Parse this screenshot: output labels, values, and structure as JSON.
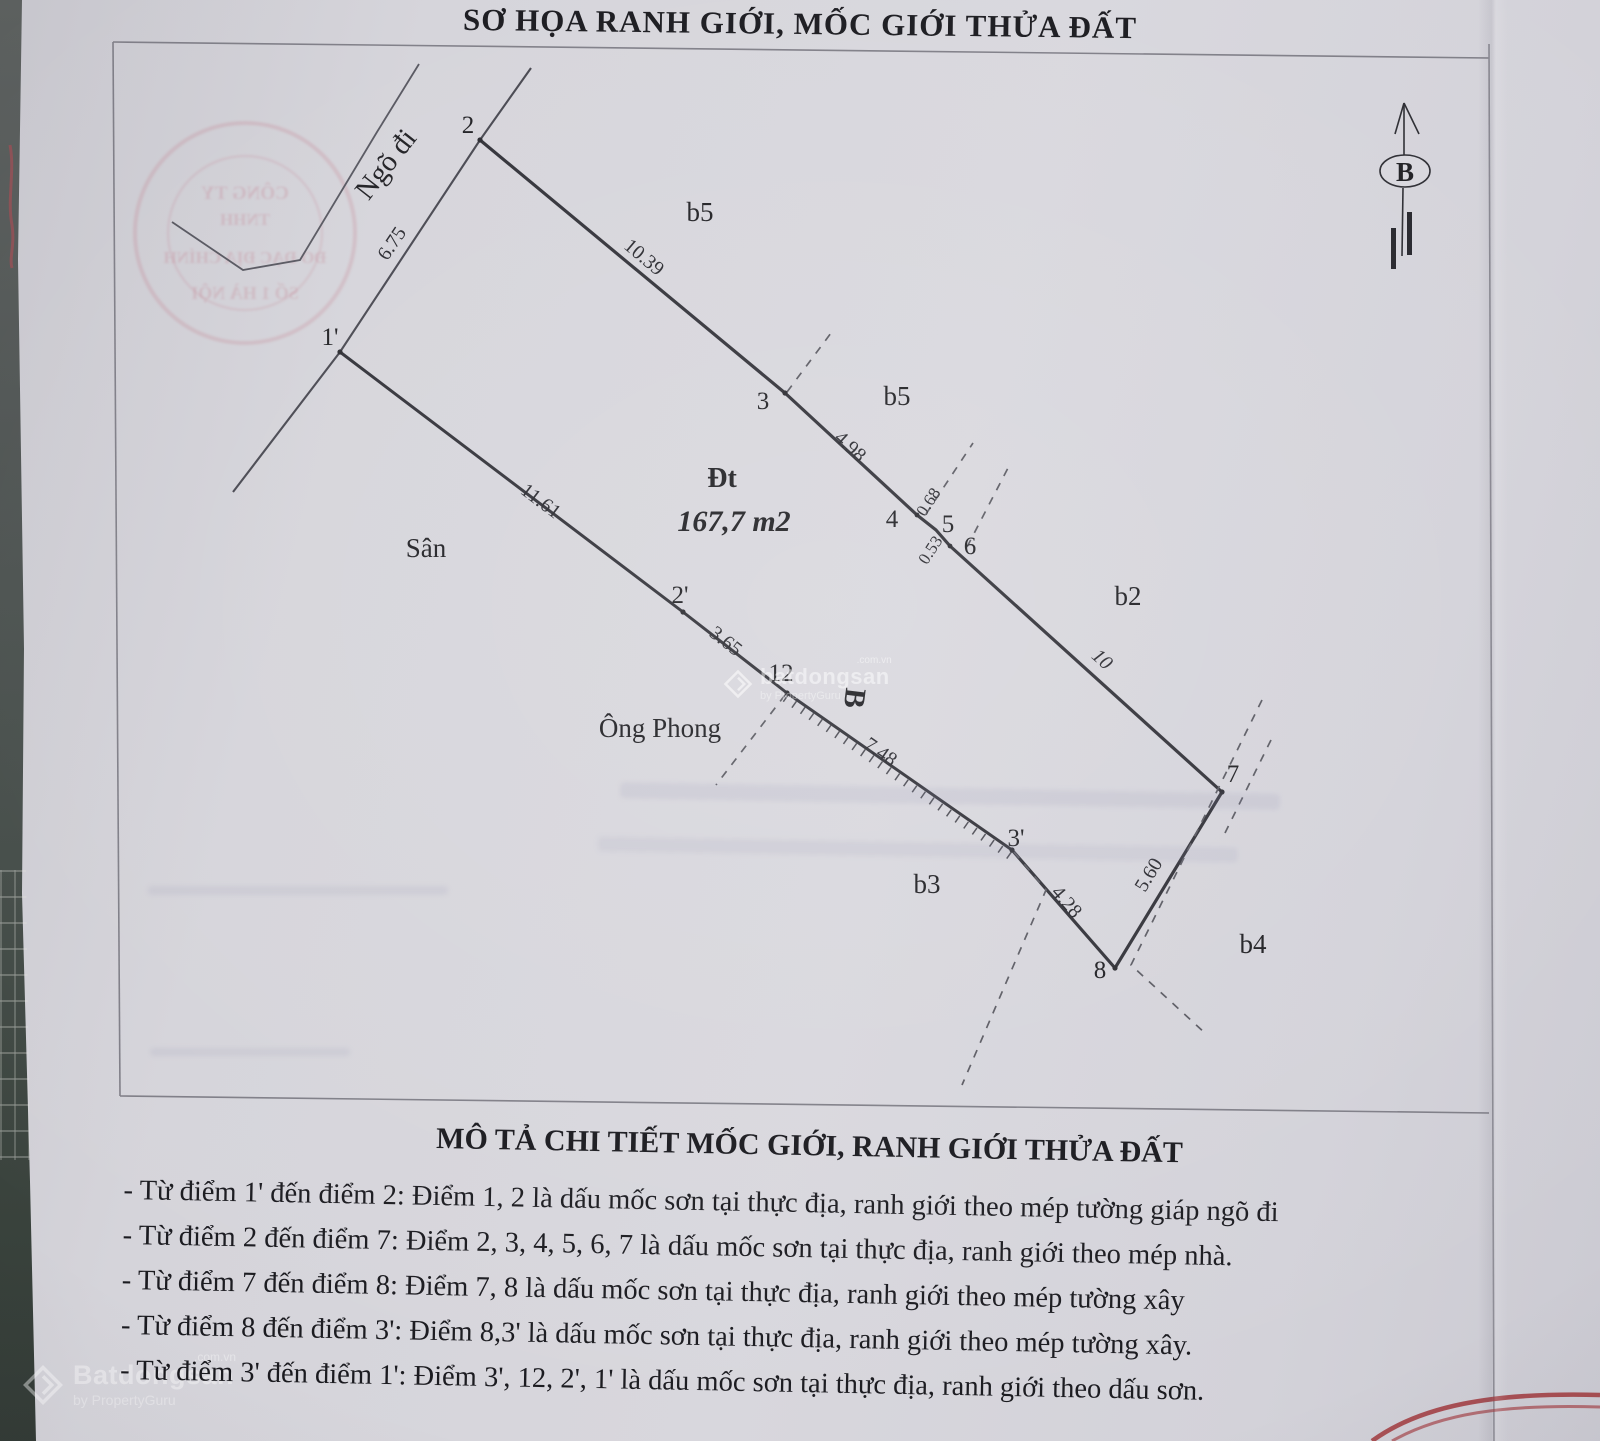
{
  "title": "SƠ HỌA RANH GIỚI, MỐC GIỚI THỬA ĐẤT",
  "north": {
    "label": "B"
  },
  "diagram": {
    "road_label": "Ngõ đi",
    "yard_label": "Sân",
    "neighbor_label": "Ông Phong",
    "plot_code": "Đt",
    "plot_area": "167,7 m2",
    "rotated_b": "B",
    "zones": {
      "b5_top": "b5",
      "b5_mid": "b5",
      "b2": "b2",
      "b3": "b3",
      "b4": "b4"
    },
    "points": {
      "p1p": "1'",
      "p2": "2",
      "p2p": "2'",
      "p3": "3",
      "p3p": "3'",
      "p4": "4",
      "p5": "5",
      "p6": "6",
      "p7": "7",
      "p8": "8",
      "p12": "12"
    },
    "lengths": {
      "l1p_2": "6.75",
      "l2_3": "10.39",
      "l3_4": "4.98",
      "l4_5": "0.68",
      "l5_6": "0.53",
      "l6_7": "10",
      "l7_8": "5.60",
      "l3p_8": "4.28",
      "l12_3p": "7.48",
      "l2p_12": "3.65",
      "l1p_2p": "11.61"
    }
  },
  "description": {
    "heading": "MÔ TẢ CHI TIẾT MỐC GIỚI, RANH GIỚI THỬA ĐẤT",
    "items": [
      "- Từ điểm 1' đến điểm 2:  Điểm 1, 2 là dấu mốc sơn tại thực địa, ranh giới theo mép tường giáp ngõ đi",
      "- Từ điểm 2 đến điểm 7:  Điểm 2, 3, 4, 5, 6, 7 là dấu mốc sơn tại thực địa, ranh giới theo mép nhà.",
      "- Từ điểm 7 đến điểm 8:  Điểm 7, 8 là dấu mốc sơn tại thực địa, ranh giới theo mép tường xây",
      "- Từ điểm 8 đến điểm 3':  Điểm 8,3' là dấu mốc sơn tại thực địa, ranh giới theo mép tường xây.",
      "- Từ điểm 3' đến điểm 1':  Điểm 3', 12, 2', 1' là dấu mốc sơn tại thực địa, ranh giới theo dấu sơn."
    ]
  },
  "stamp": {
    "lines": [
      "CÔNG TY",
      "TNHH",
      "ĐO ĐẠC ĐỊA CHÍNH",
      "SỐ 1 HÀ NỘI"
    ]
  },
  "watermark": {
    "brand": "Batdongsan",
    "brand_lower": "batdongsan",
    "domain": ".com.vn",
    "byline": "by PropertyGuru"
  },
  "colors": {
    "paper": "#d6d5db",
    "ink": "#1c1c20",
    "line": "#33333a",
    "frame": "#7e7d86",
    "stamp_red": "#b94f63",
    "arc_red": "#9e2f33"
  }
}
